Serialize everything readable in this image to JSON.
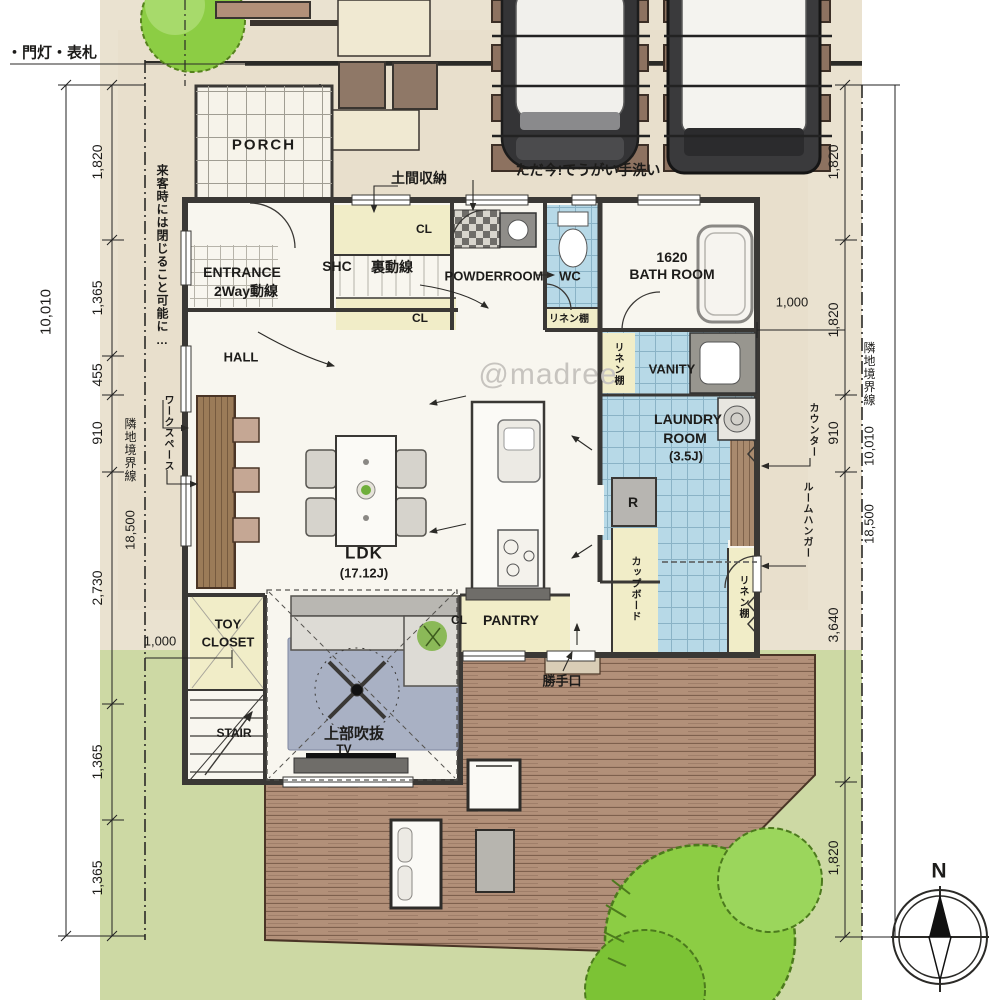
{
  "watermark": "@madree",
  "compass": {
    "north_label": "N"
  },
  "site_notes": {
    "gate_sign": "・門灯・表札",
    "visitor_note": "来客時には閉じること可能に…",
    "tadaima_note": "ただ今!でうがい手洗い",
    "boundary_label_left": "隣地境界線",
    "boundary_label_right": "隣地境界線"
  },
  "rooms": {
    "porch": "PORCH",
    "entrance_line1": "ENTRANCE",
    "entrance_line2": "2Way動線",
    "hall": "HALL",
    "shc": "SHC",
    "ura_dousen": "裏動線",
    "doma_storage": "土間収納",
    "cl_top": "CL",
    "cl_mid": "CL",
    "cl_pantry": "CL",
    "powder_room": "POWDERROOM",
    "wc": "WC",
    "bath_line1": "1620",
    "bath_line2": "BATH ROOM",
    "vanity": "VANITY",
    "laundry_line1": "LAUNDRY",
    "laundry_line2": "ROOM",
    "laundry_line3": "(3.5J)",
    "ldk_line1": "LDK",
    "ldk_line2": "(17.12J)",
    "pantry": "PANTRY",
    "toy_line1": "TOY",
    "toy_line2": "CLOSET",
    "stair": "STAIR",
    "tv": "TV",
    "fridge": "R",
    "fukinuke": "上部吹抜",
    "katteguchi": "勝手口",
    "workspace": "ワークスペース",
    "linen_wc": "リネン棚",
    "linen_vanity": "リネン棚",
    "linen_kitchen": "リネン棚",
    "counter": "カウンター",
    "room_hanger": "ルームハンガー",
    "cupboard": "カップボード"
  },
  "dimensions": {
    "left_chain": [
      "1,820",
      "1,365",
      "455",
      "910",
      "2,730",
      "1,365",
      "1,365"
    ],
    "left_total": "10,010",
    "left_boundary_len": "18,500",
    "left_offset": "1,000",
    "right_chain": [
      "1,820",
      "1,820",
      "910",
      "3,640",
      "1,820"
    ],
    "right_total": "10,010",
    "right_boundary_len": "18,500",
    "right_offset": "1,000"
  },
  "palette": {
    "site_beige": "#eae2d0",
    "lawn_green": "#cdd9a4",
    "deck_brown": "#b29079",
    "water_blue": "#b7d9e7",
    "closet_yellow": "#f1edc8",
    "tree_green": "#8ccd44",
    "wall_dark": "#3a3835",
    "watermark_gray": "#c7c4bf"
  }
}
